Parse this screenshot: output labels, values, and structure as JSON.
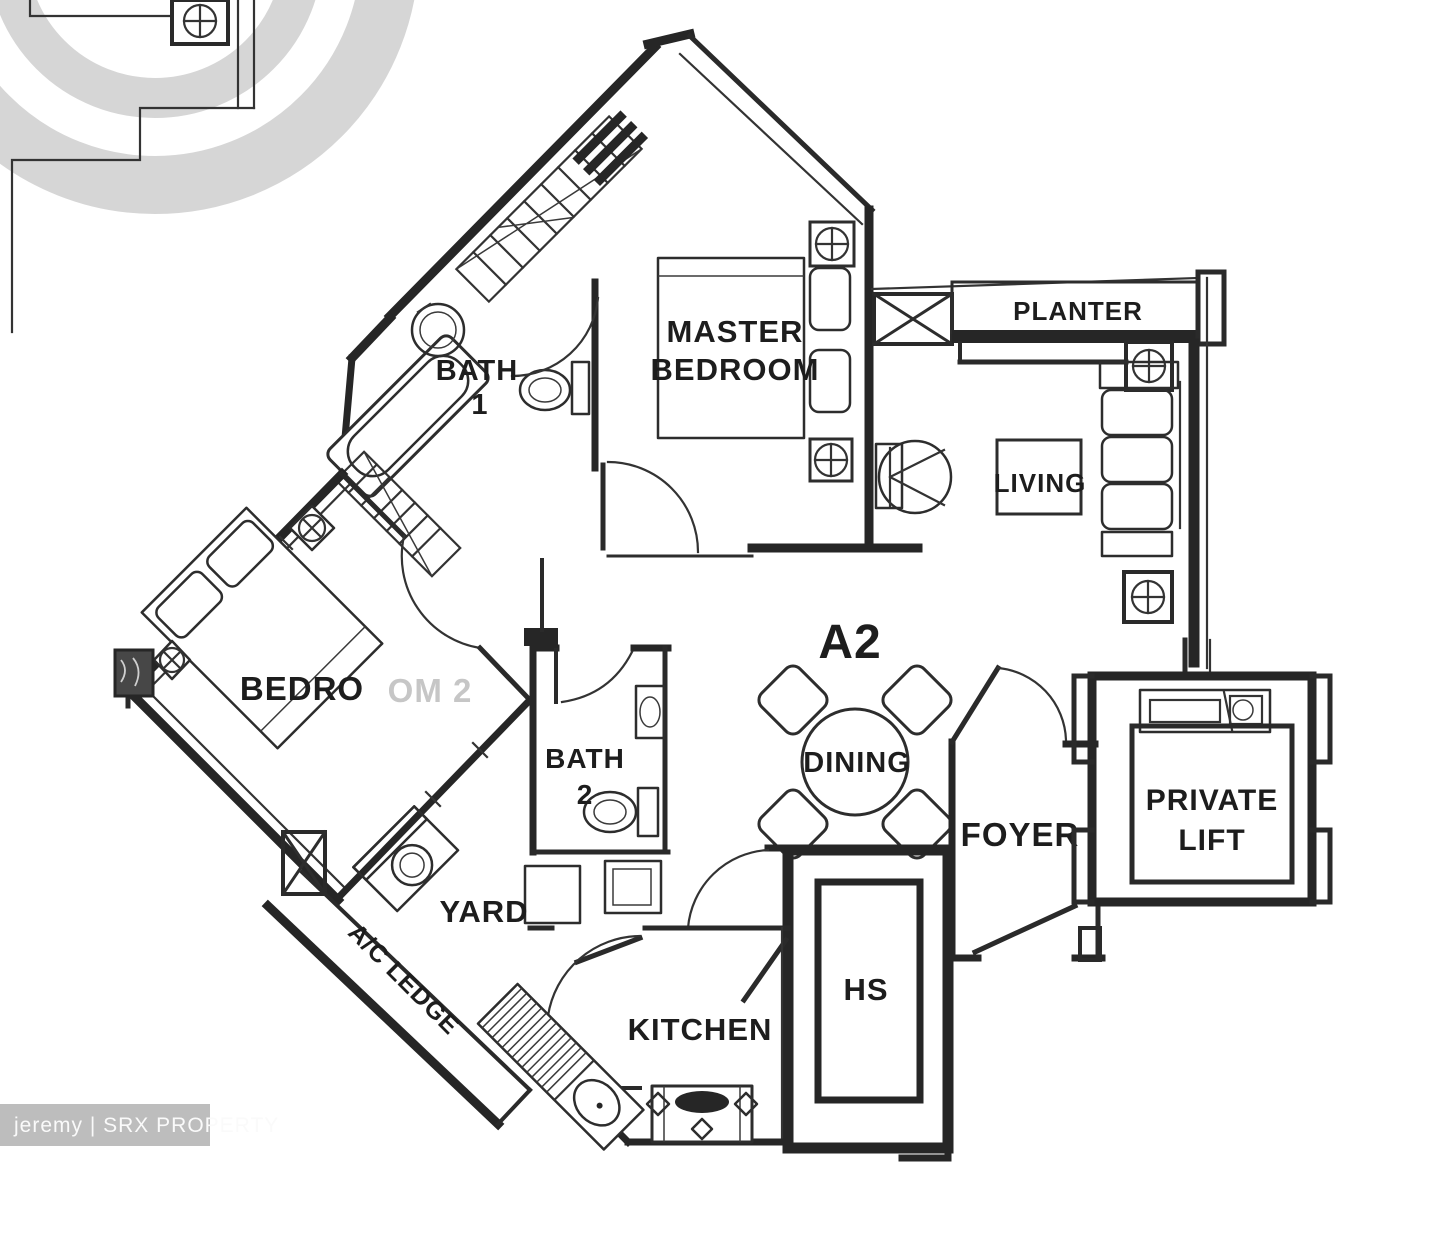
{
  "page": {
    "background": "#ffffff"
  },
  "colors": {
    "line": "#262626",
    "label": "#1d1d1d",
    "faint_label": "#c6c6c6",
    "logo_gray": "#d6d6d6",
    "badge_bg": "#bdbdbd",
    "badge_text": "#fafafa"
  },
  "unit": {
    "type_label": "A2"
  },
  "rooms": {
    "master_bedroom": {
      "line1": "MASTER",
      "line2": "BEDROOM"
    },
    "bath1": {
      "line1": "BATH",
      "line2": "1"
    },
    "bath2": {
      "line1": "BATH",
      "line2": "2"
    },
    "bedroom2": {
      "visible_part": "BEDRO",
      "faded_part": "OM 2"
    },
    "living": {
      "label": "LIVING"
    },
    "dining": {
      "label": "DINING"
    },
    "planter": {
      "label": "PLANTER"
    },
    "foyer": {
      "label": "FOYER"
    },
    "private_lift": {
      "line1": "PRIVATE",
      "line2": "LIFT"
    },
    "household_shelter": {
      "label": "HS"
    },
    "kitchen": {
      "label": "KITCHEN"
    },
    "yard": {
      "label": "YARD"
    },
    "ac_ledge": {
      "label": "A/C LEDGE"
    }
  },
  "watermark": {
    "credit": "jeremy | SRX PROPERTY"
  }
}
